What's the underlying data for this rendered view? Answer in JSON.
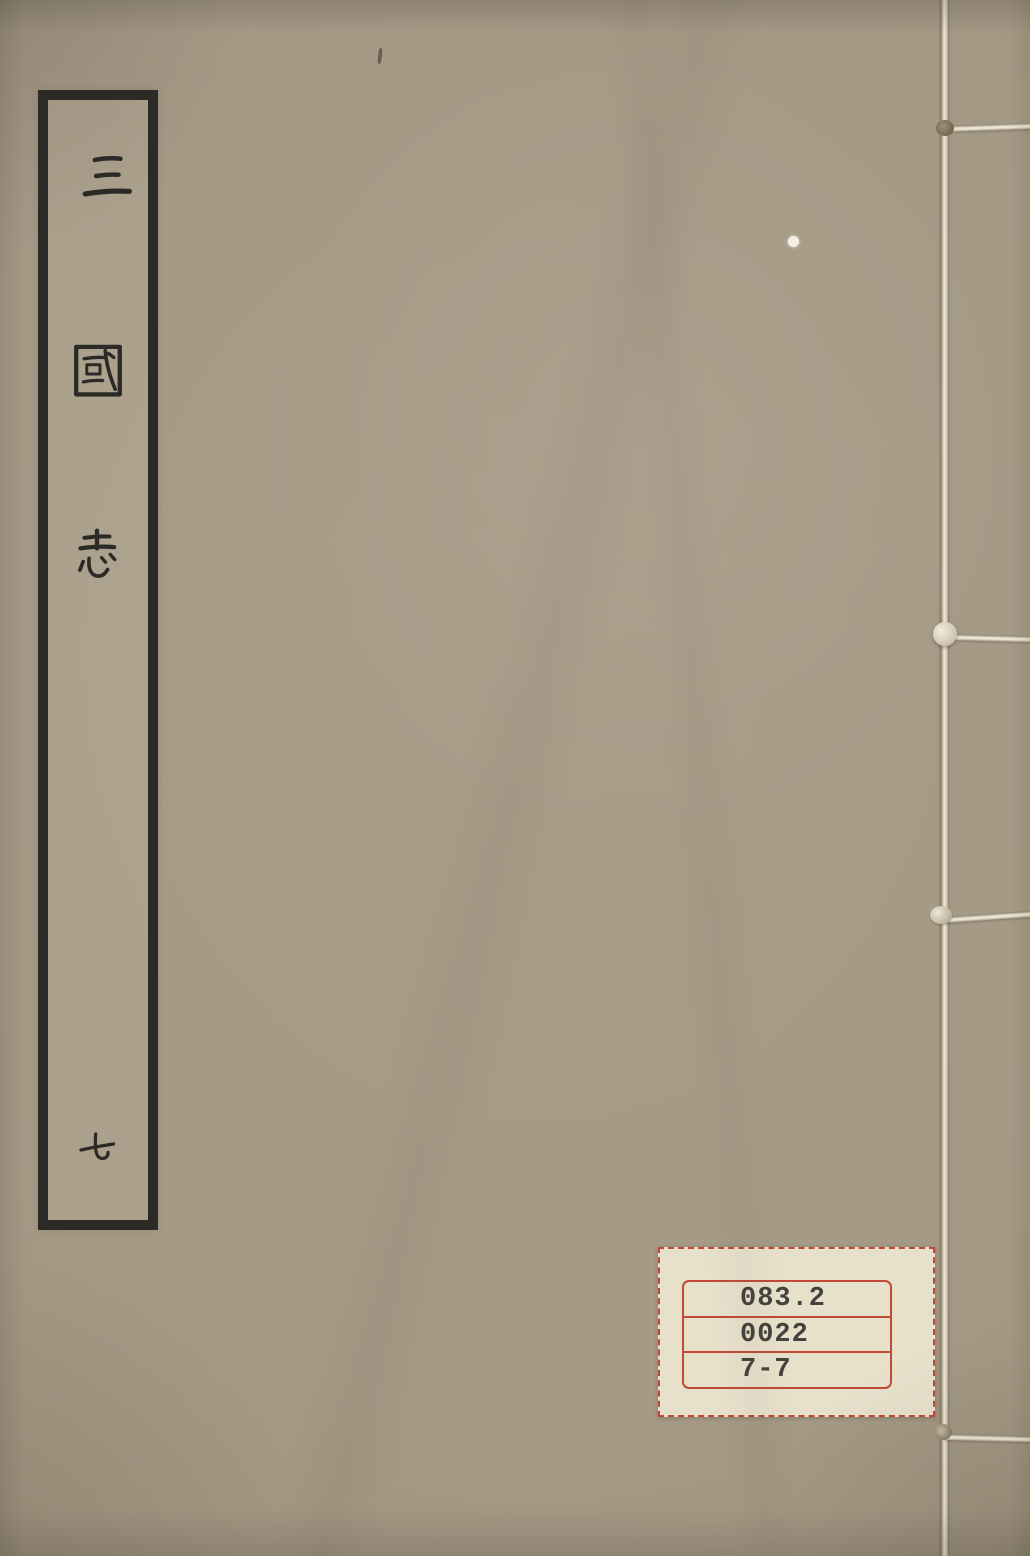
{
  "cover": {
    "title_slip": {
      "title_characters": [
        "三",
        "國",
        "志"
      ],
      "volume_character": "七",
      "full_title": "三國志 七"
    },
    "call_number_label": {
      "lines": [
        "083.2",
        "0022",
        "7-7"
      ]
    },
    "colors": {
      "cover_background": "#a49985",
      "slip_ink": "#2b2a26",
      "binding_thread": "#efe9d8",
      "label_background": "#e7e0cb",
      "label_red": "#c14a33",
      "label_text": "#44423c"
    }
  }
}
